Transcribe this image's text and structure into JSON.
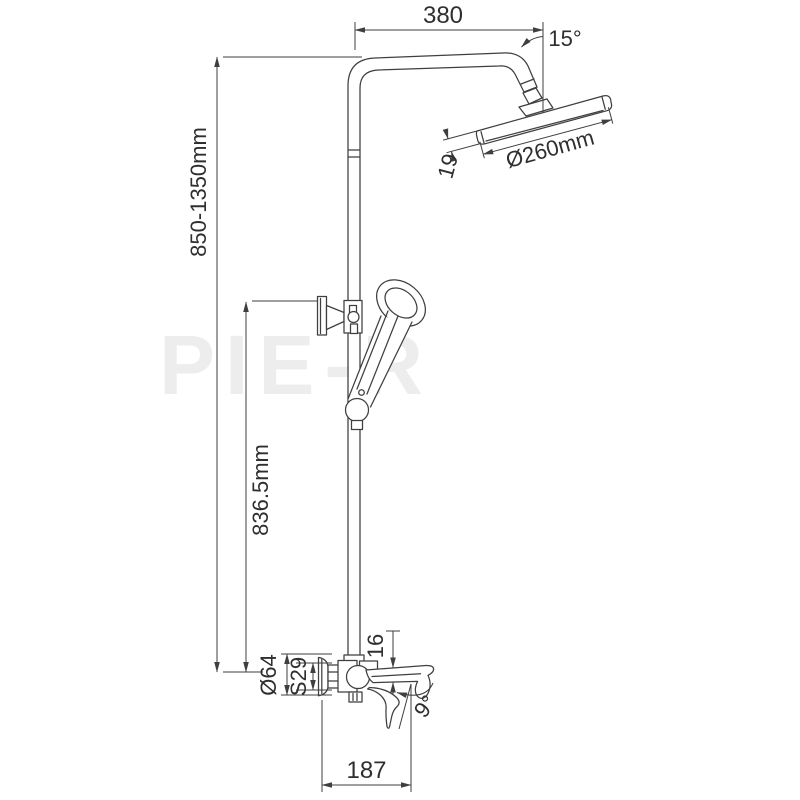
{
  "drawing": {
    "kind": "technical-dimension-drawing",
    "subject": "shower column with rain head, hand shower and wall-mounted bath mixer",
    "background_color": "#ffffff",
    "line_color": "#3f3f3f",
    "text_color": "#2f2f2f",
    "watermark": "PIE-R",
    "dimensions": {
      "top_arm_width": "380",
      "head_tilt_angle": "15°",
      "column_height_range": "850-1350mm",
      "head_diameter": "Ø260mm",
      "head_thickness": "19",
      "riser_height": "836.5mm",
      "escutcheon_diameter": "Ø64",
      "nut_size": "S29",
      "spout_end_height": "16",
      "spout_angle": "9°",
      "spout_reach": "187"
    }
  }
}
